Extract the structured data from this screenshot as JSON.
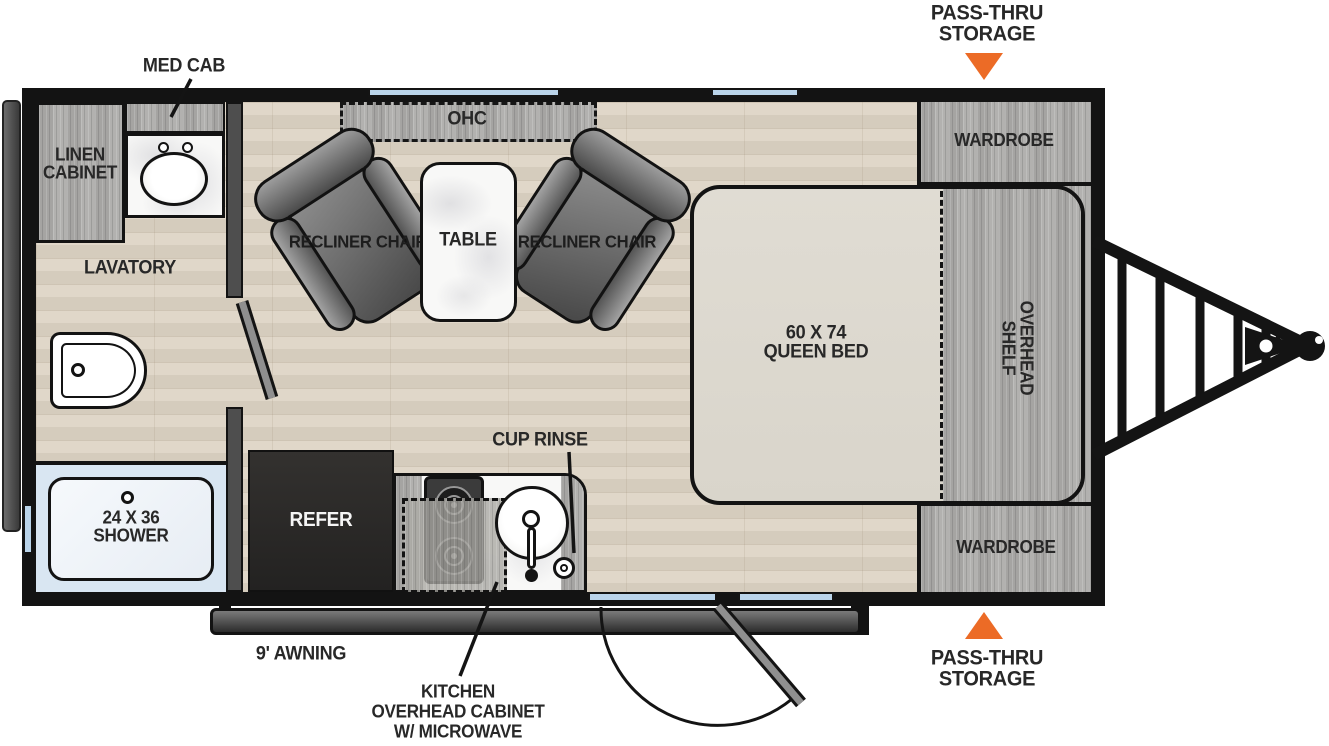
{
  "colors": {
    "accent_orange": "#EC6B26",
    "window_blue": "#BAD4EA",
    "wall_black": "#131313",
    "floor_tan": "#DCD3C3",
    "cabinet_gray": "#AEADAB"
  },
  "callouts": {
    "storage_front_top": {
      "line1": "PASS-THRU",
      "line2": "STORAGE"
    },
    "storage_front_bottom": {
      "line1": "PASS-THRU",
      "line2": "STORAGE"
    },
    "awning": "9' AWNING",
    "kitchen_overhead": {
      "line1": "KITCHEN",
      "line2": "OVERHEAD CABINET",
      "line3": "W/ MICROWAVE"
    },
    "cup_rinse": "CUP RINSE",
    "med_cab": "MED CAB"
  },
  "bathroom": {
    "linen_cabinet": {
      "line1": "LINEN",
      "line2": "CABINET"
    },
    "lavatory": "LAVATORY",
    "shower": {
      "line1": "24 X 36",
      "line2": "SHOWER"
    }
  },
  "kitchen": {
    "refrigerator": "REFER"
  },
  "living": {
    "ohc": "OHC",
    "table": "TABLE",
    "recliner_left": {
      "line1": "RECLINER",
      "line2": "CHAIR"
    },
    "recliner_right": {
      "line1": "RECLINER",
      "line2": "CHAIR"
    }
  },
  "bedroom": {
    "bed": {
      "line1": "60 X 74",
      "line2": "QUEEN BED"
    },
    "overhead_shelf": {
      "line1": "OVERHEAD",
      "line2": "SHELF"
    },
    "wardrobe_top": "WARDROBE",
    "wardrobe_bottom": "WARDROBE"
  }
}
